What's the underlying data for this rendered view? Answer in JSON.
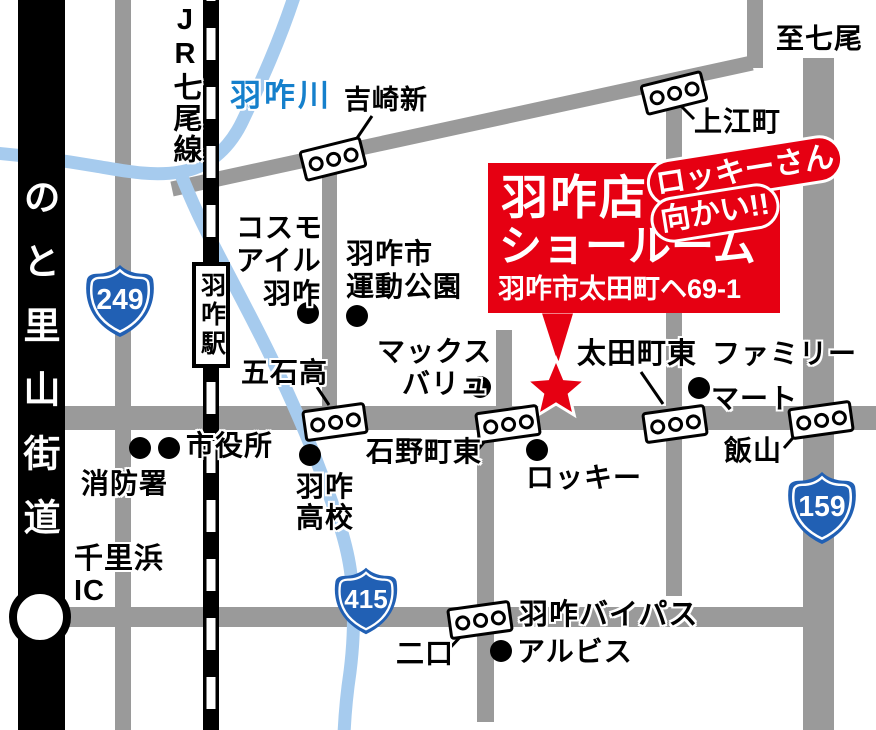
{
  "map": {
    "banner": {
      "store": "羽咋店",
      "showroom": "ショールーム",
      "address": "羽咋市太田町ヘ69-1",
      "callout_line1": "ロッキーさん",
      "callout_line2": "向かい!!"
    },
    "routes": {
      "r249": "249",
      "r415": "415",
      "r159": "159"
    },
    "labels": {
      "jr_line": "JR七尾線",
      "river": "羽咋川",
      "noto_road": "のと里山街道",
      "station": "羽咋駅",
      "yoshizaki": "吉崎新",
      "to_nanao": "至七尾",
      "kaminae": "上江町",
      "cosmo_l1": "コスモ",
      "cosmo_l2": "アイル",
      "cosmo_l3": "羽咋",
      "undo_l1": "羽咋市",
      "undo_l2": "運動公園",
      "max_l1": "マックス",
      "max_l2": "バリュ",
      "otamachi": "太田町東",
      "family_l1": "ファミリー",
      "family_l2": "マート",
      "goseki": "五石高",
      "city_hall": "市役所",
      "fire_station": "消防署",
      "hs_l1": "羽咋",
      "hs_l2": "高校",
      "ishino": "石野町東",
      "rocky": "ロッキー",
      "iiyama": "飯山",
      "chirihama_l1": "千里浜",
      "chirihama_l2": "IC",
      "bypass": "羽咋バイパス",
      "futakuchi": "二口",
      "albis": "アルビス"
    },
    "icons": {
      "traffic_signal": "three-circle-signal-box",
      "poi_dot": "black-circle",
      "location_star": "red-star",
      "interchange": "white-circle-on-expressway"
    },
    "colors": {
      "road_gray": "#9a9a9a",
      "expressway_black": "#000000",
      "river_blue": "#a6cbee",
      "river_label_blue": "#1580cc",
      "route_shield_blue": "#2160b4",
      "accent_red": "#e60012"
    }
  }
}
